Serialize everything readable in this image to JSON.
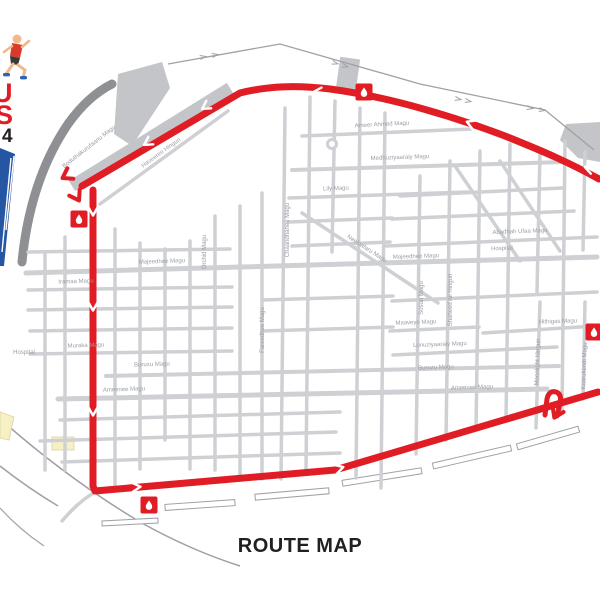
{
  "page": {
    "footer_title": "ROUTE MAP",
    "background": "#ffffff"
  },
  "logo": {
    "runner_icon": "runner-clipart",
    "text_fragment_1": "U",
    "text_fragment_2": "S",
    "text_fragment_3": "4"
  },
  "colors": {
    "route_red": "#e01c24",
    "street_gray": "#ced0d4",
    "label_gray": "#9b9da2",
    "breakwater_dark_gray": "#8f9094",
    "land_gray": "#c3c5c9",
    "seawall_gray": "#9fa1a5",
    "pier_fill": "#ffffff",
    "yellow_block": "#f7f0c4",
    "logo_blue": "#2456a4",
    "logo_red": "#e01c24",
    "title_black": "#231f20",
    "marker_drop_white": "#ffffff"
  },
  "map": {
    "street_labels": [
      {
        "text": "Boduthakurufaanu Magu"
      },
      {
        "text": "Haveeree Hingun"
      },
      {
        "text": "Ameer Ahmed Magu"
      },
      {
        "text": "Medhuziyaaraiy Magu"
      },
      {
        "text": "Lily Magu"
      },
      {
        "text": "Majeedhee Magu"
      },
      {
        "text": "Majeedhee Magu"
      },
      {
        "text": "Abadhah Ufaa Magu"
      },
      {
        "text": "Maaveyo Magu"
      },
      {
        "text": "Hithigas Magu"
      },
      {
        "text": "Lonuziyaaraiy Magu"
      },
      {
        "text": "Buruzu Magu"
      },
      {
        "text": "Buruzu Magu"
      },
      {
        "text": "Ameenee Magu"
      },
      {
        "text": "Ameenee Magu"
      },
      {
        "text": "Iramaa Magu"
      },
      {
        "text": "Muraka Magu"
      },
      {
        "text": "Chaandhanee Magu"
      },
      {
        "text": "Orchid Magu"
      },
      {
        "text": "Sosun Magu"
      },
      {
        "text": "Shaheed Ali Hingun"
      },
      {
        "text": "Fareedhee Magu"
      },
      {
        "text": "Moonlight Hingun"
      },
      {
        "text": "Koarukendi Magu"
      },
      {
        "text": "Neeloafaru Magu"
      }
    ],
    "poi_labels": [
      {
        "text": "Hospital"
      },
      {
        "text": "Hospital"
      }
    ],
    "markers": [
      {
        "name": "water-station",
        "icon": "water-drop-icon"
      },
      {
        "name": "water-station",
        "icon": "water-drop-icon"
      },
      {
        "name": "water-station",
        "icon": "water-drop-icon"
      },
      {
        "name": "water-station",
        "icon": "water-drop-icon"
      }
    ]
  }
}
